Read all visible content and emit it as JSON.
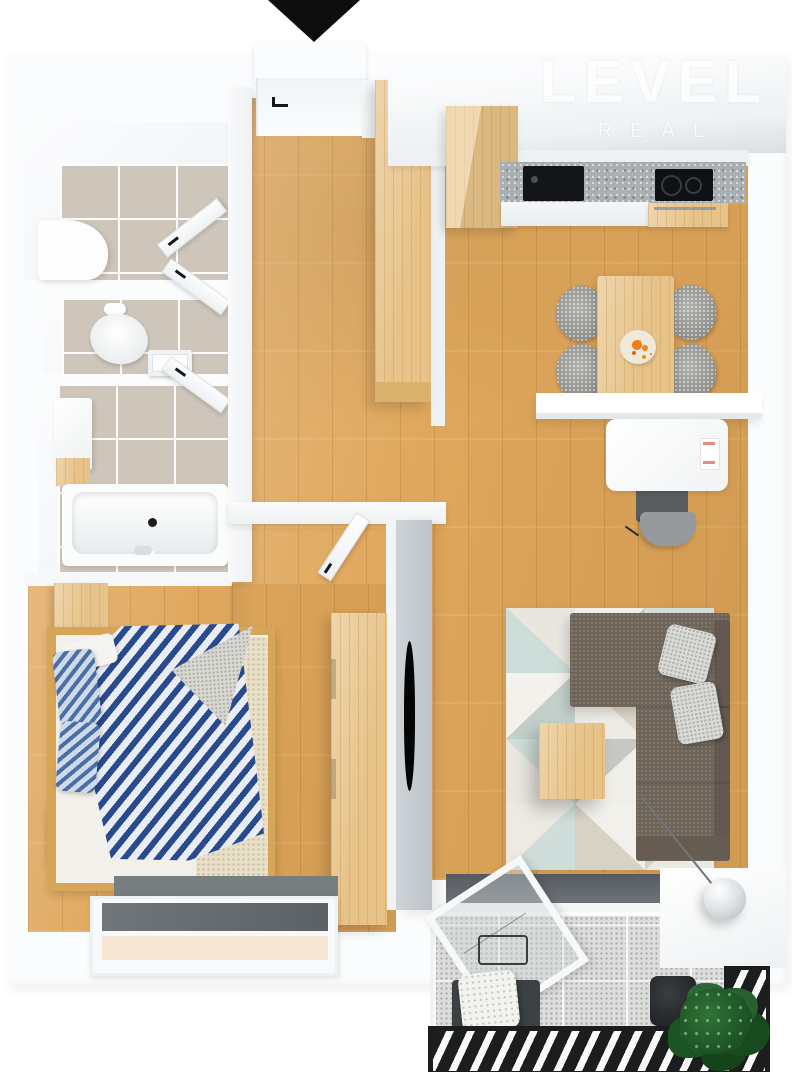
{
  "watermark": {
    "line1": "LEVEL",
    "line2": "REAL"
  },
  "icons": {
    "entrance-arrow": "triangle-down"
  },
  "colors": {
    "wall-white": "#f6f8f9",
    "wood-floor": "#dfa75c",
    "wood-furniture": "#e7c389",
    "tile-beige": "#cec6bb",
    "countertop-gray": "#a9afb3",
    "appliance-black": "#141518",
    "sofa-taupe": "#6e6459",
    "pillow-gray": "#d9d9d5",
    "duvet-navy": "#2a4a8e",
    "duvet-white": "#e9ecf2",
    "rug-teal": "#cfdeda",
    "rug-cream": "#eceae3",
    "balcony-floor": "#dddedb",
    "railing-black": "#1b1d1e",
    "plant-green": "#1d5424",
    "fruit-orange": "#ed7d14",
    "watermark-white": "#ffffff"
  }
}
